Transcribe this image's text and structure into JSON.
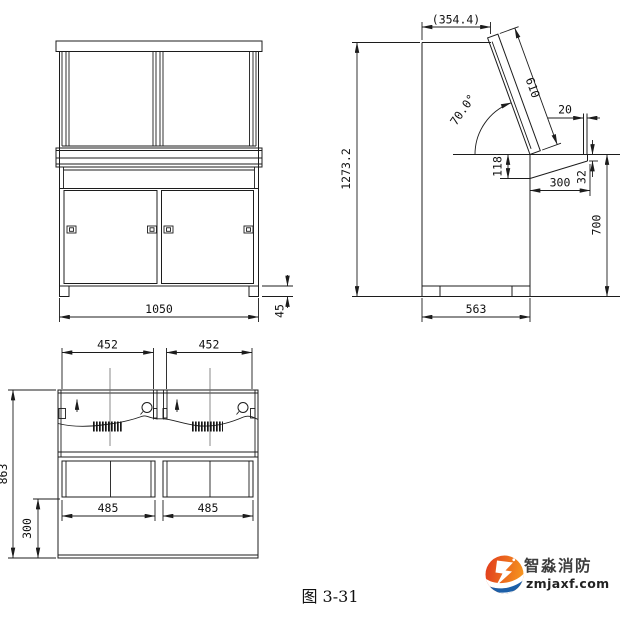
{
  "drawing": {
    "front_view": {
      "overall_width": "1050",
      "foot_height": "45"
    },
    "side_view": {
      "top_depth": "(354.4)",
      "panel_length": "610",
      "panel_angle": "70.0°",
      "board_thickness": "20",
      "front_drop": "118",
      "ledge_depth": "300",
      "ledge_edge_thickness": "32",
      "desk_height": "700",
      "overall_height": "1273.2",
      "body_depth": "563"
    },
    "plan_view": {
      "door_span_left": "452",
      "door_span_right": "452",
      "overall_depth": "863",
      "rear_depth": "300",
      "opening_left": "485",
      "opening_right": "485"
    },
    "caption": "图 3-31"
  },
  "logo": {
    "name": "智淼消防",
    "site": "zmjaxf.com"
  },
  "colors": {
    "line": "#1c1c1c",
    "logo_orange": "#f6971f",
    "logo_red": "#e2401d",
    "logo_blue_dark": "#1c5fa8",
    "logo_blue_light": "#3e97d6"
  }
}
